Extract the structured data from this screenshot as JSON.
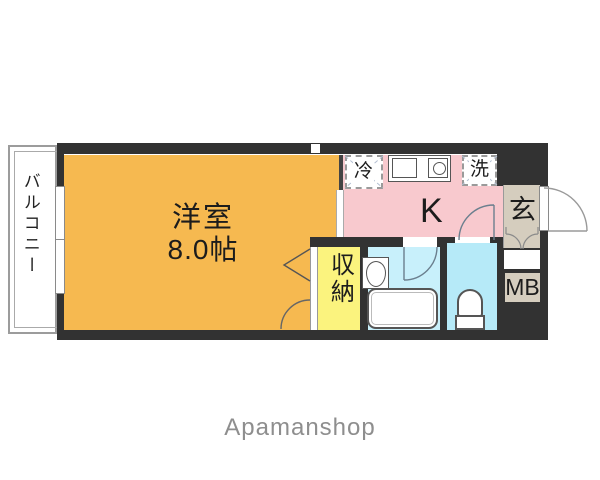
{
  "floorplan": {
    "balcony": {
      "label": "バルコニー"
    },
    "main_room": {
      "label": "洋室",
      "size": "8.0帖"
    },
    "kitchen": {
      "label": "K",
      "fridge_label": "冷",
      "washer_label": "洗"
    },
    "entrance": {
      "label": "玄"
    },
    "closet": {
      "label": "収納"
    },
    "meter_box": {
      "label": "MB"
    },
    "colors": {
      "wall": "#323232",
      "main_room": "#F6B950",
      "kitchen": "#F8C9CE",
      "closet": "#FBF37E",
      "bathroom": "#C8F0FB",
      "toilet": "#B6EAF8",
      "entrance": "#D5CDBE",
      "meter_box": "#D5CDBE"
    }
  },
  "footer": {
    "brand": "Apamanshop"
  }
}
